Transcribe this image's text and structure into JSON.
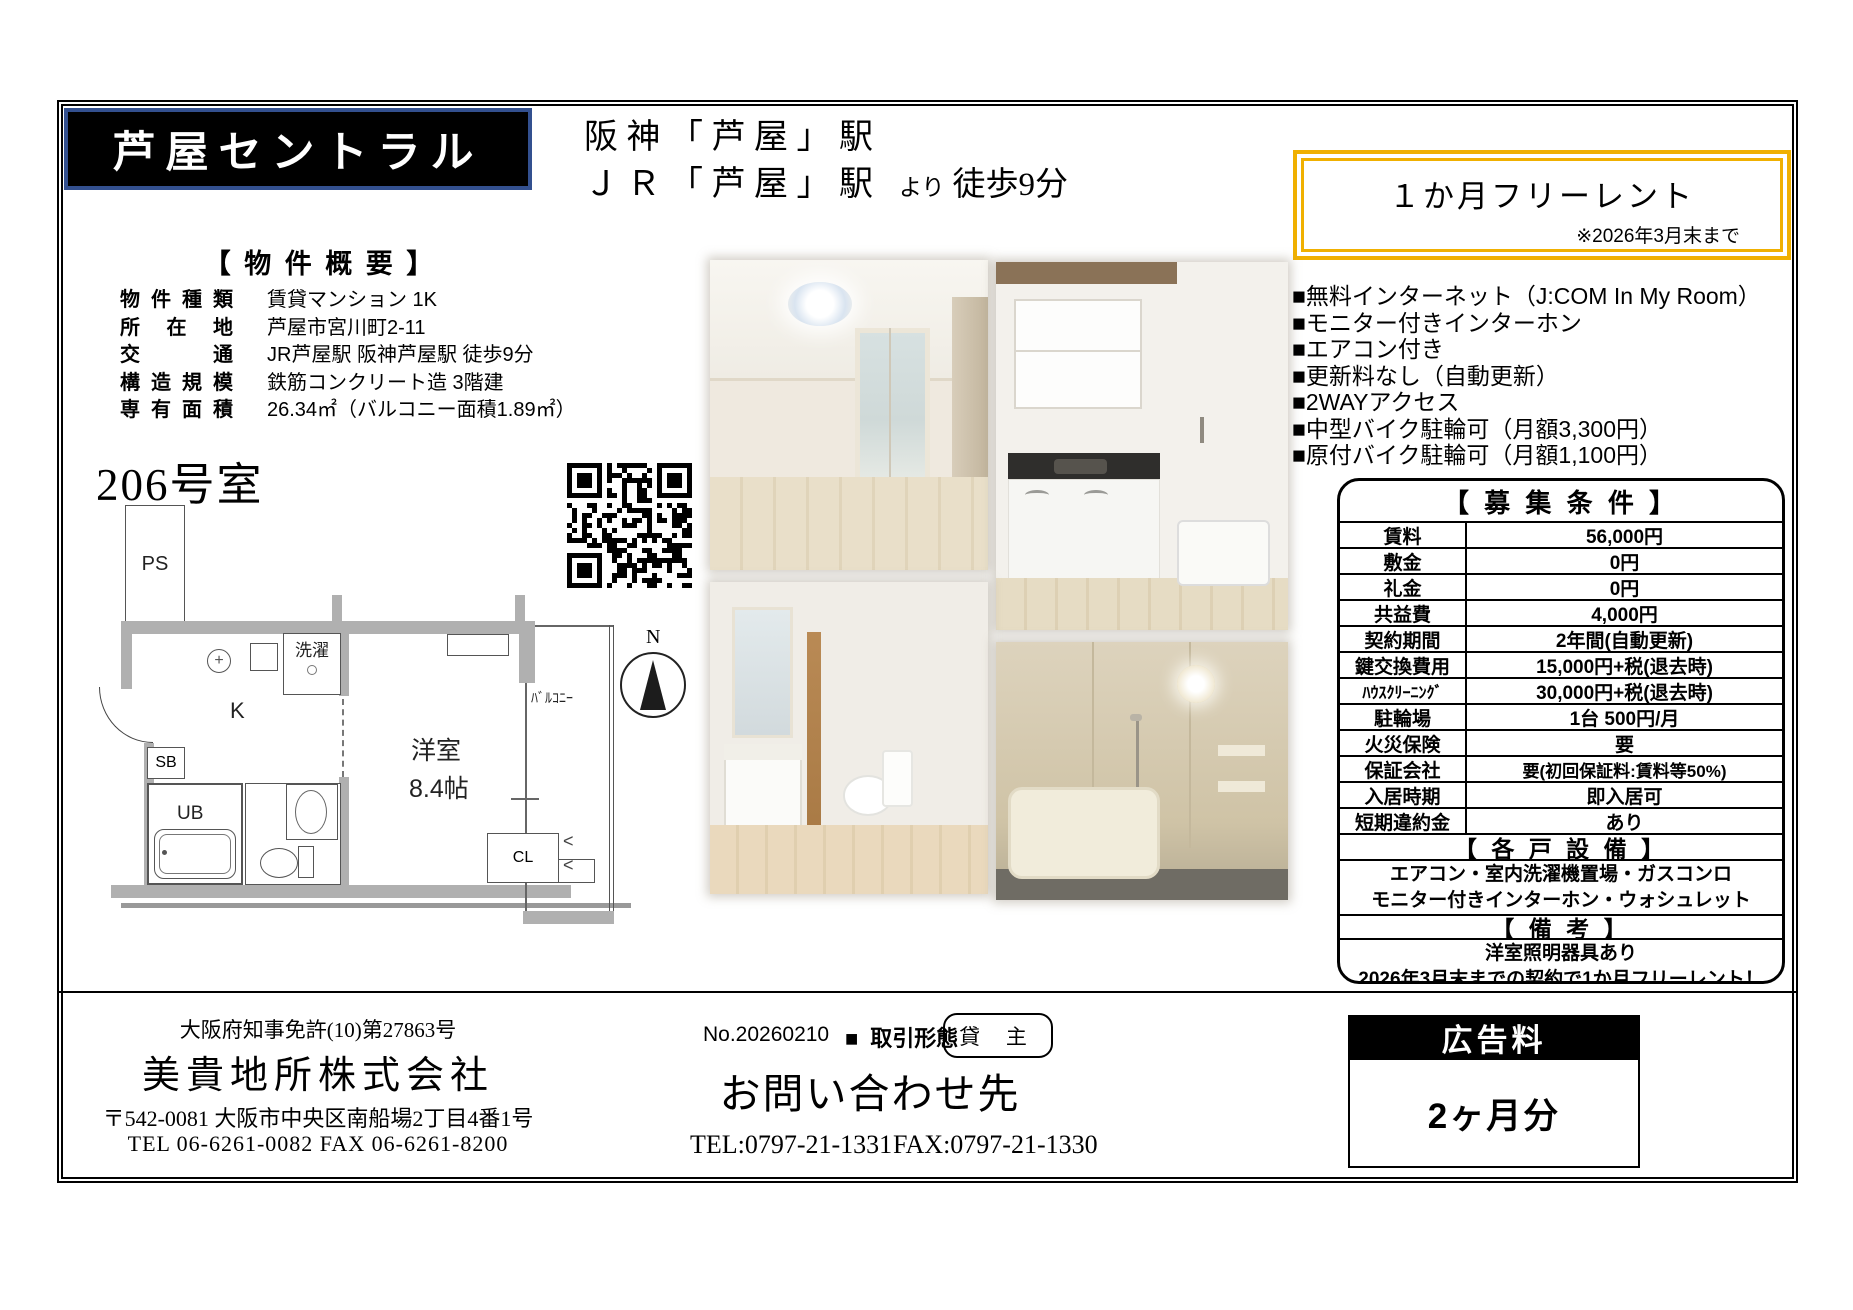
{
  "header": {
    "title": "芦屋セントラル",
    "station_line1": "阪 神 「 芦 屋 」 駅",
    "station_line2": "Ｊ Ｒ 「 芦 屋 」 駅",
    "station_more": "より",
    "station_walk": "徒歩9分",
    "free_rent_label": "１か月フリーレント",
    "free_rent_note": "※2026年3月末まで",
    "accent_gold": "#f0b000",
    "title_border_blue": "#33508f"
  },
  "overview": {
    "heading": "【 物 件 概 要 】",
    "rows": [
      {
        "label": "物件種類",
        "value": "賃貸マンション 1K"
      },
      {
        "label": "所在地",
        "value": "芦屋市宮川町2-11"
      },
      {
        "label": "交通",
        "value": "JR芦屋駅 阪神芦屋駅 徒歩9分"
      },
      {
        "label": "構造規模",
        "value": "鉄筋コンクリート造 3階建"
      },
      {
        "label": "専有面積",
        "value": "26.34㎡（バルコニー面積1.89㎡）"
      }
    ]
  },
  "room_label": "206号室",
  "floorplan": {
    "ps": "PS",
    "laundry": "洗濯",
    "kitchen": "K",
    "sb": "SB",
    "ub": "UB",
    "room": "洋室",
    "room_size": "8.4帖",
    "balcony": "ﾊﾞﾙｺﾆｰ",
    "closet": "CL",
    "north": "N"
  },
  "features": [
    "■無料インターネット（J:COM In My Room）",
    "■モニター付きインターホン",
    "■エアコン付き",
    "■更新料なし（自動更新）",
    "■2WAYアクセス",
    "■中型バイク駐輪可（月額3,300円）",
    "■原付バイク駐輪可（月額1,100円）"
  ],
  "conditions": {
    "heading": "【 募 集 条 件 】",
    "rows": [
      {
        "label": "賃料",
        "value": "56,000円"
      },
      {
        "label": "敷金",
        "value": "0円"
      },
      {
        "label": "礼金",
        "value": "0円"
      },
      {
        "label": "共益費",
        "value": "4,000円"
      },
      {
        "label": "契約期間",
        "value": "2年間(自動更新)"
      },
      {
        "label": "鍵交換費用",
        "value": "15,000円+税(退去時)"
      },
      {
        "label": "ﾊｳｽｸﾘｰﾆﾝｸﾞ",
        "value": "30,000円+税(退去時)"
      },
      {
        "label": "駐輪場",
        "value": "1台 500円/月"
      },
      {
        "label": "火災保険",
        "value": "要"
      },
      {
        "label": "保証会社",
        "value": "要(初回保証料:賃料等50%)"
      },
      {
        "label": "入居時期",
        "value": "即入居可"
      },
      {
        "label": "短期違約金",
        "value": "あり"
      }
    ],
    "equipment_heading": "【 各 戸 設 備 】",
    "equipment_line1": "エアコン・室内洗濯機置場・ガスコンロ",
    "equipment_line2": "モニター付きインターホン・ウォシュレット",
    "remarks_heading": "【 備 考 】",
    "remarks_line1": "洋室照明器具あり",
    "remarks_line2": "2026年3月末までの契約で1か月フリーレント！"
  },
  "footer": {
    "license": "大阪府知事免許(10)第27863号",
    "company": "美貴地所株式会社",
    "address": "〒542-0081 大阪市中央区南船場2丁目4番1号",
    "company_tel_fax": "TEL 06-6261-0082  FAX 06-6261-8200",
    "doc_no": "No.20260210",
    "deal_type_bullet": "■",
    "deal_type_label": "取引形態",
    "deal_type_value": "貸 主",
    "contact_heading": "お問い合わせ先",
    "contact_tel": "TEL:0797-21-1331",
    "contact_fax": "FAX:0797-21-1330",
    "ad_fee_label": "広告料",
    "ad_fee_value": "2ヶ月分"
  }
}
